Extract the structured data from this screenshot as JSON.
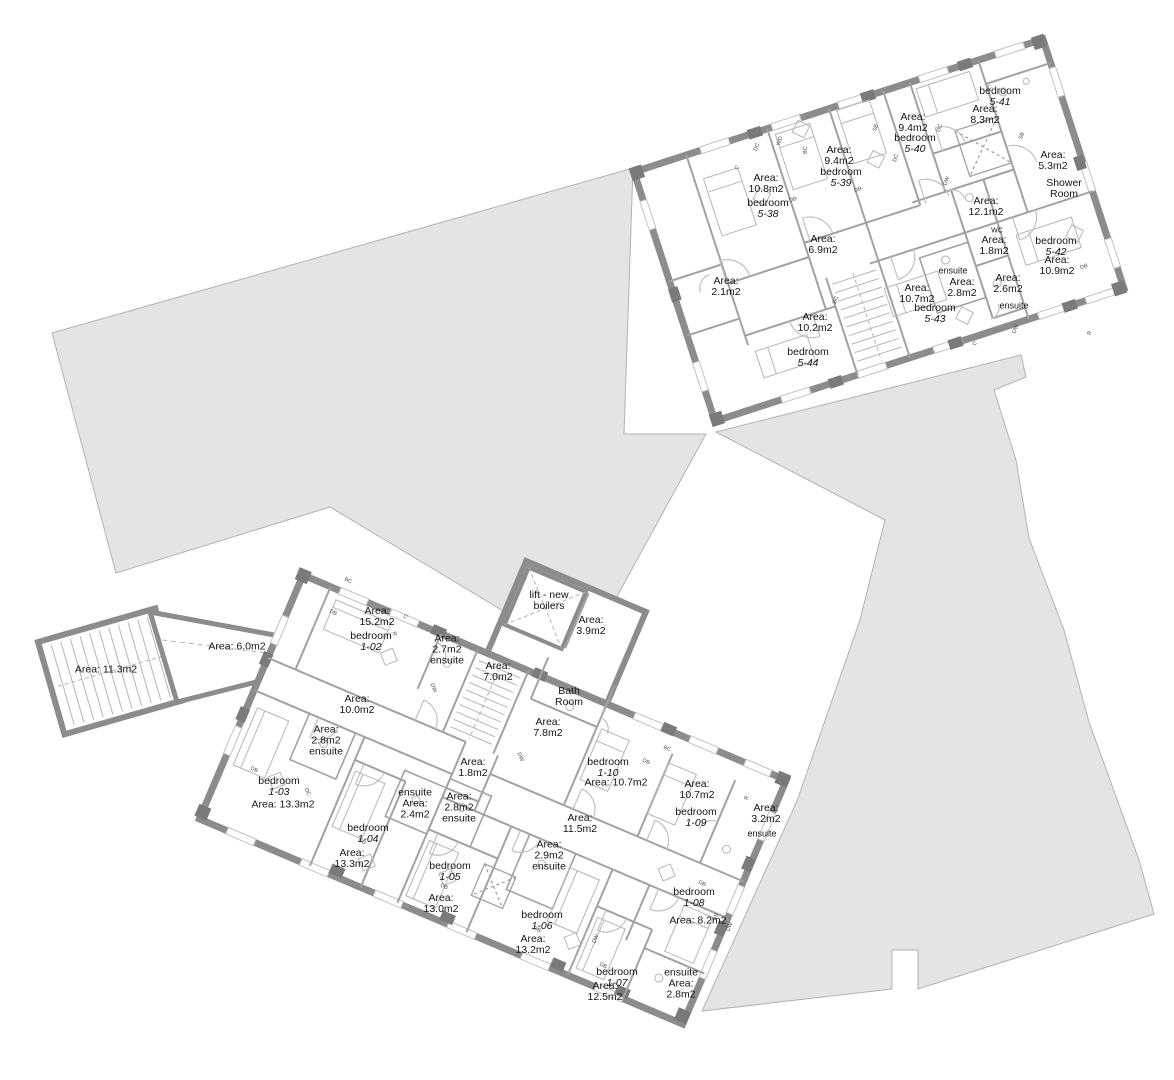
{
  "document": {
    "type": "architectural floor plan",
    "area_unit": "m2",
    "buildings_shown": 2
  },
  "colors": {
    "background": "#ffffff",
    "site_mass_fill": "#e4e4e4",
    "site_mass_stroke": "#b2b2b2",
    "wall": "#8c8c8c",
    "pier": "#7a7a7a",
    "partition": "#a2a2a2",
    "furniture": "#b6b6b6",
    "door_arc": "#c0c0c0",
    "text": "#141414"
  },
  "labels": {
    "upper_building": [
      {
        "lines": [
          "Area:",
          "10.8m2"
        ],
        "x": 766,
        "y": 184
      },
      {
        "lines": [
          "bedroom",
          "5-38"
        ],
        "x": 768,
        "y": 209
      },
      {
        "lines": [
          "Area:",
          "9.4m2"
        ],
        "x": 839,
        "y": 156
      },
      {
        "lines": [
          "bedroom",
          "5-39"
        ],
        "x": 841,
        "y": 178
      },
      {
        "lines": [
          "Area:",
          "9.4m2"
        ],
        "x": 913,
        "y": 123
      },
      {
        "lines": [
          "bedroom",
          "5-40"
        ],
        "x": 915,
        "y": 144
      },
      {
        "lines": [
          "bedroom",
          "5-41"
        ],
        "x": 1000,
        "y": 97
      },
      {
        "lines": [
          "Area:",
          "8.3m2"
        ],
        "x": 985,
        "y": 115
      },
      {
        "lines": [
          "Area:",
          "5.3m2"
        ],
        "x": 1053,
        "y": 161
      },
      {
        "lines": [
          "Shower",
          "Room"
        ],
        "x": 1064,
        "y": 189
      },
      {
        "lines": [
          "Area:",
          "12.1m2"
        ],
        "x": 986,
        "y": 207
      },
      {
        "lines": [
          "Area:",
          "6.9m2"
        ],
        "x": 823,
        "y": 245
      },
      {
        "lines": [
          "Area:",
          "2.1m2"
        ],
        "x": 726,
        "y": 287
      },
      {
        "lines": [
          "Area:",
          "10.2m2"
        ],
        "x": 815,
        "y": 323
      },
      {
        "lines": [
          "bedroom",
          "5-44"
        ],
        "x": 808,
        "y": 358
      },
      {
        "lines": [
          "Area:",
          "10.7m2"
        ],
        "x": 917,
        "y": 294
      },
      {
        "lines": [
          "bedroom",
          "5-43"
        ],
        "x": 935,
        "y": 314
      },
      {
        "lines": [
          "ensuite"
        ],
        "x": 953,
        "y": 271,
        "s": 9
      },
      {
        "lines": [
          "Area:",
          "2.8m2"
        ],
        "x": 962,
        "y": 288
      },
      {
        "lines": [
          "WC"
        ],
        "x": 997,
        "y": 231,
        "s": 7
      },
      {
        "lines": [
          "Area:",
          "1.8m2"
        ],
        "x": 994,
        "y": 246
      },
      {
        "lines": [
          "Area:",
          "2.6m2"
        ],
        "x": 1008,
        "y": 284
      },
      {
        "lines": [
          "ensuite"
        ],
        "x": 1014,
        "y": 306,
        "s": 9
      },
      {
        "lines": [
          "bedroom",
          "5-42"
        ],
        "x": 1056,
        "y": 247
      },
      {
        "lines": [
          "Area:",
          "10.9m2"
        ],
        "x": 1057,
        "y": 266
      }
    ],
    "lower_building": [
      {
        "lines": [
          "Area: 11.3m2"
        ],
        "x": 106,
        "y": 670
      },
      {
        "lines": [
          "Area: 6.0m2"
        ],
        "x": 237,
        "y": 647
      },
      {
        "lines": [
          "Area:",
          "15.2m2"
        ],
        "x": 377,
        "y": 617
      },
      {
        "lines": [
          "bedroom",
          "1-02"
        ],
        "x": 371,
        "y": 642
      },
      {
        "lines": [
          "Area:",
          "2.7m2",
          "ensuite"
        ],
        "x": 447,
        "y": 650
      },
      {
        "lines": [
          "Area:",
          "7.0m2"
        ],
        "x": 498,
        "y": 672
      },
      {
        "lines": [
          "lift - new",
          "boilers"
        ],
        "x": 549,
        "y": 601
      },
      {
        "lines": [
          "Area:",
          "3.9m2"
        ],
        "x": 591,
        "y": 626
      },
      {
        "lines": [
          "Bath",
          "Room"
        ],
        "x": 569,
        "y": 697
      },
      {
        "lines": [
          "Area:",
          "7.8m2"
        ],
        "x": 548,
        "y": 728
      },
      {
        "lines": [
          "Area:",
          "10.0m2"
        ],
        "x": 357,
        "y": 705
      },
      {
        "lines": [
          "Area:",
          "2.8m2",
          "ensuite"
        ],
        "x": 326,
        "y": 741
      },
      {
        "lines": [
          "bedroom",
          "1-03"
        ],
        "x": 279,
        "y": 787
      },
      {
        "lines": [
          "Area: 13.3m2"
        ],
        "x": 283,
        "y": 805
      },
      {
        "lines": [
          "bedroom",
          "1-04"
        ],
        "x": 368,
        "y": 834
      },
      {
        "lines": [
          "Area:",
          "13.3m2"
        ],
        "x": 352,
        "y": 859
      },
      {
        "lines": [
          "ensuite",
          "Area:",
          "2.4m2"
        ],
        "x": 415,
        "y": 804
      },
      {
        "lines": [
          "Area:",
          "1.8m2"
        ],
        "x": 473,
        "y": 768
      },
      {
        "lines": [
          "Area:",
          "2.8m2",
          "ensuite"
        ],
        "x": 459,
        "y": 808
      },
      {
        "lines": [
          "Area:",
          "11.5m2"
        ],
        "x": 580,
        "y": 824
      },
      {
        "lines": [
          "Area:",
          "2.9m2",
          "ensuite"
        ],
        "x": 549,
        "y": 856
      },
      {
        "lines": [
          "bedroom",
          "1-05"
        ],
        "x": 450,
        "y": 872
      },
      {
        "lines": [
          "Area:",
          "13.0m2"
        ],
        "x": 441,
        "y": 904
      },
      {
        "lines": [
          "bedroom",
          "1-06"
        ],
        "x": 542,
        "y": 921
      },
      {
        "lines": [
          "Area:",
          "13.2m2"
        ],
        "x": 533,
        "y": 945
      },
      {
        "lines": [
          "bedroom",
          "1-07"
        ],
        "x": 617,
        "y": 978
      },
      {
        "lines": [
          "Area:",
          "12.5m2"
        ],
        "x": 605,
        "y": 992
      },
      {
        "lines": [
          "ensuite",
          "Area:",
          "2.8m2"
        ],
        "x": 681,
        "y": 984
      },
      {
        "lines": [
          "bedroom",
          "1-08"
        ],
        "x": 694,
        "y": 898
      },
      {
        "lines": [
          "Area: 8.2m2"
        ],
        "x": 698,
        "y": 921
      },
      {
        "lines": [
          "bedroom",
          "1-10"
        ],
        "x": 608,
        "y": 768
      },
      {
        "lines": [
          "Area: 10.7m2"
        ],
        "x": 616,
        "y": 783
      },
      {
        "lines": [
          "Area:",
          "10.7m2"
        ],
        "x": 697,
        "y": 790
      },
      {
        "lines": [
          "bedroom",
          "1-09"
        ],
        "x": 696,
        "y": 818
      },
      {
        "lines": [
          "Area:",
          "3.2m2"
        ],
        "x": 766,
        "y": 814
      },
      {
        "lines": [
          "ensuite"
        ],
        "x": 762,
        "y": 834,
        "s": 9
      }
    ],
    "furniture_tags": [
      {
        "t": "DC",
        "x": 757,
        "y": 147,
        "r": -72
      },
      {
        "t": "WD",
        "x": 780,
        "y": 141,
        "r": -72
      },
      {
        "t": "BC",
        "x": 806,
        "y": 150,
        "r": -90
      },
      {
        "t": "C",
        "x": 737,
        "y": 168,
        "r": -30
      },
      {
        "t": "DB",
        "x": 793,
        "y": 200,
        "r": -18
      },
      {
        "t": "SB",
        "x": 876,
        "y": 128,
        "r": -72
      },
      {
        "t": "DC",
        "x": 896,
        "y": 158,
        "r": -72
      },
      {
        "t": "DB",
        "x": 858,
        "y": 190,
        "r": -18
      },
      {
        "t": "SB",
        "x": 1022,
        "y": 136,
        "r": -72
      },
      {
        "t": "DW",
        "x": 947,
        "y": 181,
        "r": -72
      },
      {
        "t": "DC",
        "x": 940,
        "y": 128,
        "r": -72
      },
      {
        "t": "C",
        "x": 990,
        "y": 88,
        "r": -30
      },
      {
        "t": "DB",
        "x": 1084,
        "y": 267,
        "r": -18
      },
      {
        "t": "R",
        "x": 1090,
        "y": 333,
        "r": -72
      },
      {
        "t": "DW",
        "x": 1016,
        "y": 329,
        "r": -72
      },
      {
        "t": "BC",
        "x": 836,
        "y": 300,
        "r": -72
      },
      {
        "t": "C",
        "x": 975,
        "y": 344,
        "r": -30
      },
      {
        "t": "BC",
        "x": 348,
        "y": 581,
        "r": 23
      },
      {
        "t": "DB",
        "x": 333,
        "y": 613,
        "r": 23
      },
      {
        "t": "C",
        "x": 405,
        "y": 617,
        "r": 45
      },
      {
        "t": "R",
        "x": 394,
        "y": 634,
        "r": 67
      },
      {
        "t": "DW",
        "x": 433,
        "y": 688,
        "r": 67
      },
      {
        "t": "DB",
        "x": 254,
        "y": 770,
        "r": 23
      },
      {
        "t": "DC",
        "x": 307,
        "y": 792,
        "r": 67
      },
      {
        "t": "DB",
        "x": 362,
        "y": 842,
        "r": 23
      },
      {
        "t": "DB",
        "x": 444,
        "y": 887,
        "r": 23
      },
      {
        "t": "DB",
        "x": 537,
        "y": 930,
        "r": 23
      },
      {
        "t": "DB",
        "x": 603,
        "y": 966,
        "r": 23
      },
      {
        "t": "DB",
        "x": 646,
        "y": 762,
        "r": 23
      },
      {
        "t": "DB",
        "x": 702,
        "y": 884,
        "r": 23
      },
      {
        "t": "DW",
        "x": 730,
        "y": 927,
        "r": -67
      },
      {
        "t": "R",
        "x": 747,
        "y": 798,
        "r": -67
      },
      {
        "t": "BS",
        "x": 716,
        "y": 917,
        "r": -67
      },
      {
        "t": "DW",
        "x": 596,
        "y": 939,
        "r": -67
      },
      {
        "t": "BC",
        "x": 667,
        "y": 749,
        "r": 23
      },
      {
        "t": "DW",
        "x": 520,
        "y": 757,
        "r": 67
      }
    ]
  }
}
